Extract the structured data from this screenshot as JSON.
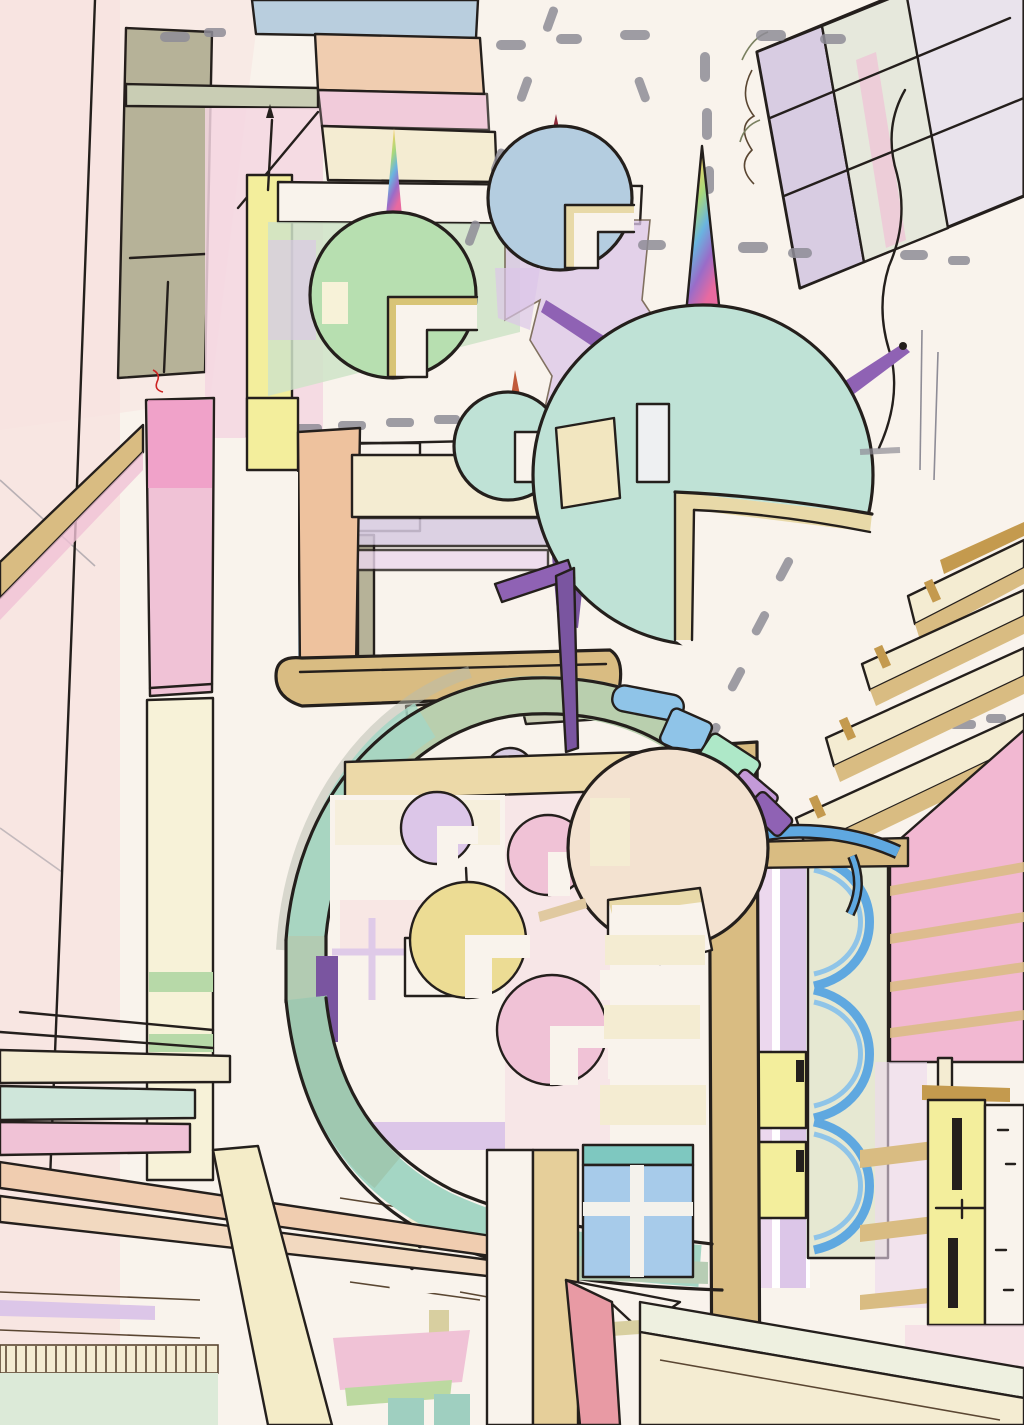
{
  "artwork": {
    "title": "floating-pod-city-sketch",
    "medium": "ink and colored pencil on paper",
    "orientation": "portrait",
    "width_px": 1024,
    "height_px": 1425
  },
  "palette": {
    "paper": "#f9f3ec",
    "pink_paper": "#f7e2e0",
    "pink_wash": "#f4d6e2",
    "rose": "#f0c2d6",
    "bright_pink": "#f09ac6",
    "pink_wall": "#f2b8d2",
    "red_wall": "#e89aa4",
    "lavender": "#dcc6e8",
    "lavender_pale": "#ecd8ee",
    "lilac_gray": "#d8cce2",
    "purple": "#8f62b4",
    "deep_purple": "#7a55a0",
    "yellow": "#f3ee9c",
    "pod_yellow": "#ecdc94",
    "pale_yellow": "#f7f2d8",
    "cream": "#f4ecd2",
    "lip_cream": "#e8d9a8",
    "tan": "#d9bc82",
    "ochre": "#c49a4e",
    "olive": "#b6b298",
    "olive_face": "#e6e8d2",
    "gray_green": "#c9cdb4",
    "sage": "#b9cfae",
    "teal": "#bfe2d6",
    "teal_band": "#a4d6c4",
    "teal_pale": "#cfe6da",
    "green": "#b7dfb0",
    "green_pale": "#cfe3c8",
    "mint": "#aee8c8",
    "blue": "#8fc4e8",
    "blue_deep": "#5fa8e0",
    "steel": "#a7cbea",
    "sky_blue": "#b4cde0",
    "slab_blue": "#b9cede",
    "peach": "#f0cdb0",
    "apricot": "#eec29e",
    "pale_sphere": "#f3e2d0",
    "maroon": "#8c2b3a",
    "rust": "#c05a3a",
    "red": "#d93434",
    "dark_red": "#8f1a1a",
    "ink": "#241f1c",
    "ink_brown": "#5a4632",
    "pencil": "#8e8c96"
  },
  "scene": {
    "sky": {
      "dashed_guide_lines": "gray pencil dashes running horizontally, vertically and diagonally",
      "photo_corner_color": "red, top-right corner"
    },
    "floating_pods": [
      {
        "name": "green-pod",
        "body": "green",
        "spire": "rainbow",
        "windows": 2,
        "notch": "lower-right"
      },
      {
        "name": "blue-pod",
        "body": "sky_blue",
        "spire": "maroon",
        "windows": 2,
        "notch": "lower-right"
      },
      {
        "name": "small-teal-pod",
        "body": "teal",
        "spire": "rust",
        "windows": 2,
        "notch": "right"
      },
      {
        "name": "large-teal-pod",
        "body": "teal",
        "spire": "rainbow",
        "antennas": "purple",
        "windows": 2,
        "notch": "large mouth lower-right"
      },
      {
        "name": "pale-pod",
        "body": "pale_sphere",
        "windows": 2,
        "notch": "lower-left"
      },
      {
        "name": "small-dome-pod",
        "body": "lilac_gray"
      },
      {
        "name": "lavender-pod",
        "body": "lavender",
        "notch": "lower-right"
      },
      {
        "name": "pink-pod",
        "body": "rose",
        "notch": "lower-right"
      },
      {
        "name": "yellow-pod",
        "body": "pod_yellow",
        "spire": "thin",
        "notch": "lower-right"
      },
      {
        "name": "rose-pod",
        "body": "rose",
        "notch": "lower-right"
      }
    ],
    "architecture": {
      "arch_ring": {
        "band": [
          "sage",
          "teal_band"
        ],
        "tiles": [
          "blue",
          "blue",
          "mint",
          "purple",
          "purple"
        ]
      },
      "left_district": [
        "olive column",
        "pink column",
        "yellow strip wall",
        "apricot column",
        "stacked beams",
        "hatched footing"
      ],
      "center_top_stack": [
        "slab_blue",
        "peach",
        "rose",
        "cream"
      ],
      "tilted_roof_slab": [
        "lilac_gray panels"
      ],
      "right_district": [
        "diagonal tan bleacher beams",
        "pink striped wall",
        "lavender columns",
        "blue scalloped arcs tower",
        "yellow tower with black slots",
        "white tower"
      ],
      "bottom_district": [
        "dotted dome",
        "low building with dot windows",
        "booth with hatched door",
        "teal columns",
        "blue window with diagonal glazing",
        "red wall block",
        "tilted cream slab"
      ]
    },
    "accents": [
      "purple seven-shaped hook",
      "purple antennas",
      "rainbow unicorn spires"
    ]
  }
}
